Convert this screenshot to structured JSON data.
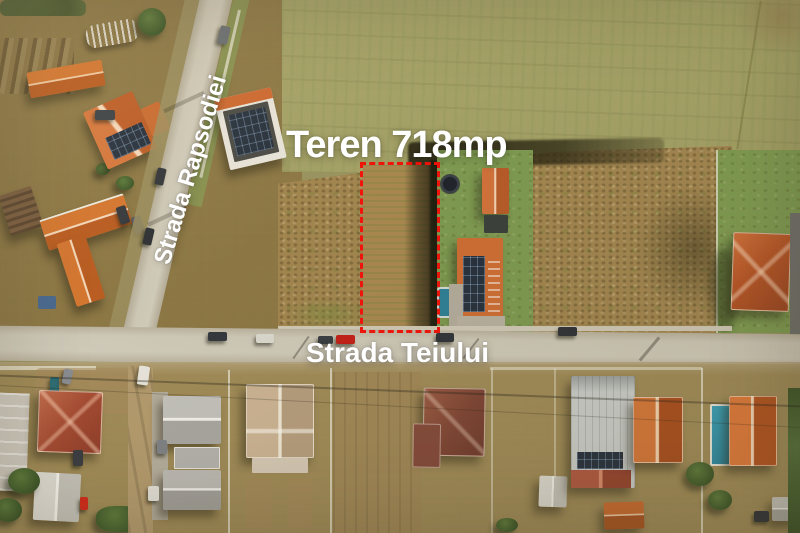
{
  "overlay": {
    "title": "Teren 718mp",
    "street_diagonal": "Strada Rapsodiei",
    "street_horizontal": "Strada Teiului"
  },
  "colors": {
    "plot_outline": "#f2130a",
    "overlay_text": "#ffffff",
    "field_olive": "#a3a065",
    "scrub_brown": "#a1854f",
    "lawn_green": "#7d9950",
    "roof_orange": "#cc6a2e",
    "road_asphalt": "#c8c2b0"
  }
}
